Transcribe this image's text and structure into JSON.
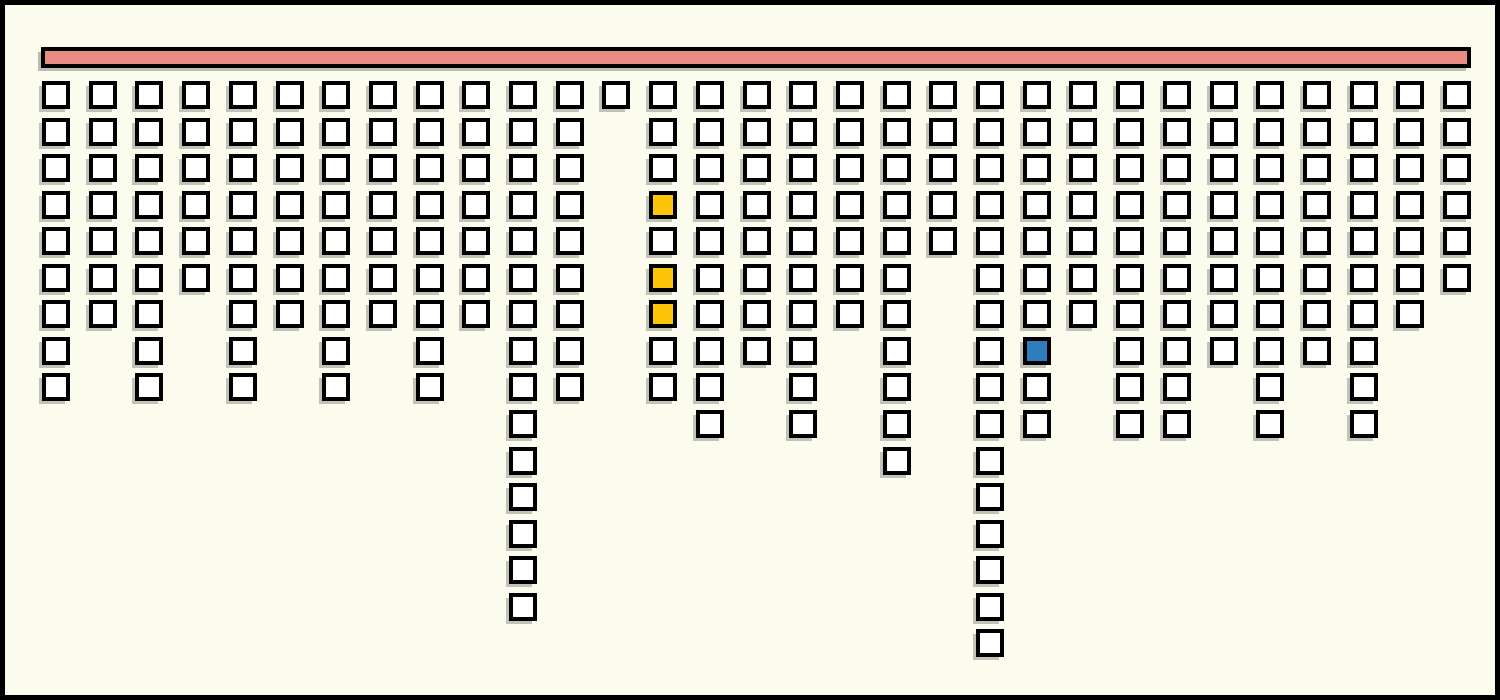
{
  "canvas": {
    "background_color": "#fbfbee",
    "frame_color": "#000000"
  },
  "bar": {
    "fill_color": "#e98c83",
    "border_color": "#000000"
  },
  "square_style": {
    "fill_color": "#ffffff",
    "border_color": "#000000",
    "shadow_color": "#9a9a92"
  },
  "colors": {
    "yellow": "#fdc509",
    "blue": "#2e7ebe",
    "white": "#ffffff"
  },
  "chart_data": {
    "type": "bar",
    "title": "",
    "xlabel": "",
    "ylabel": "",
    "categories": [
      1,
      2,
      3,
      4,
      5,
      6,
      7,
      8,
      9,
      10,
      11,
      12,
      13,
      14,
      15,
      16,
      17,
      18,
      19,
      20,
      21,
      22,
      23,
      24,
      25,
      26,
      27,
      28,
      29,
      30,
      31
    ],
    "values": [
      9,
      7,
      9,
      6,
      9,
      7,
      9,
      7,
      9,
      7,
      15,
      9,
      1,
      9,
      10,
      8,
      10,
      7,
      11,
      5,
      16,
      10,
      7,
      10,
      10,
      8,
      10,
      8,
      10,
      7,
      6
    ],
    "ylim": [
      0,
      16
    ],
    "orientation": "columns-hang-downward-from-top-bar",
    "grid": "off",
    "legend": "none",
    "highlights": [
      {
        "col": 14,
        "row": 4,
        "color": "yellow"
      },
      {
        "col": 14,
        "row": 6,
        "color": "yellow"
      },
      {
        "col": 14,
        "row": 7,
        "color": "yellow"
      },
      {
        "col": 22,
        "row": 8,
        "color": "blue"
      }
    ]
  }
}
